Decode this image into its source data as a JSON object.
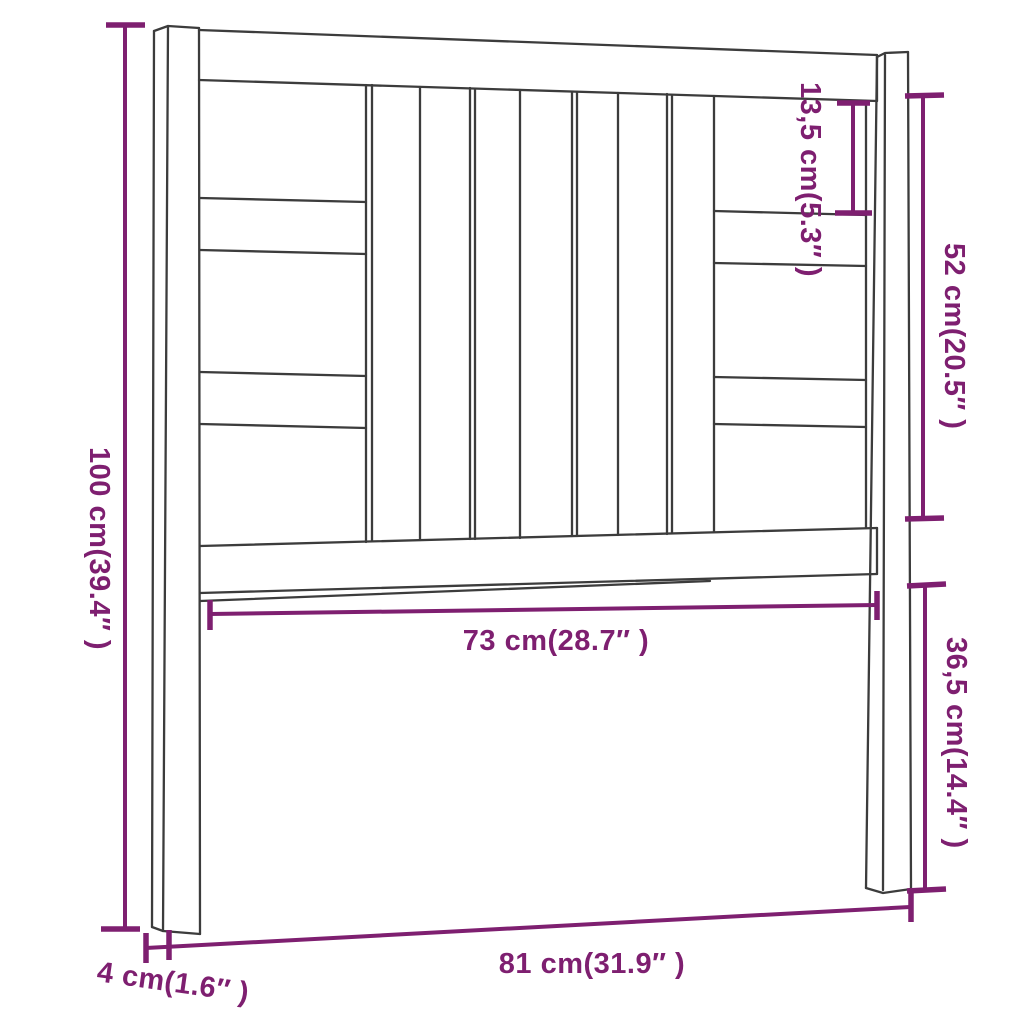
{
  "diagram": {
    "kind": "furniture-dimension-drawing",
    "subject": "bed headboard with slats and side posts",
    "colors": {
      "dimension_annotation": "#7e1f70",
      "drawing_outline": "#3c3c3c",
      "background": "#ffffff"
    },
    "dimensions": {
      "total_height": "100 cm(39.4″ )",
      "top_gap": "13,5 cm(5.3″ )",
      "upper_panel_height": "52 cm(20.5″ )",
      "lower_leg_height": "36,5 cm(14.4″ )",
      "inner_width": "73 cm(28.7″ )",
      "total_width": "81 cm(31.9″ )",
      "post_thickness": "4 cm(1.6″ )"
    }
  }
}
